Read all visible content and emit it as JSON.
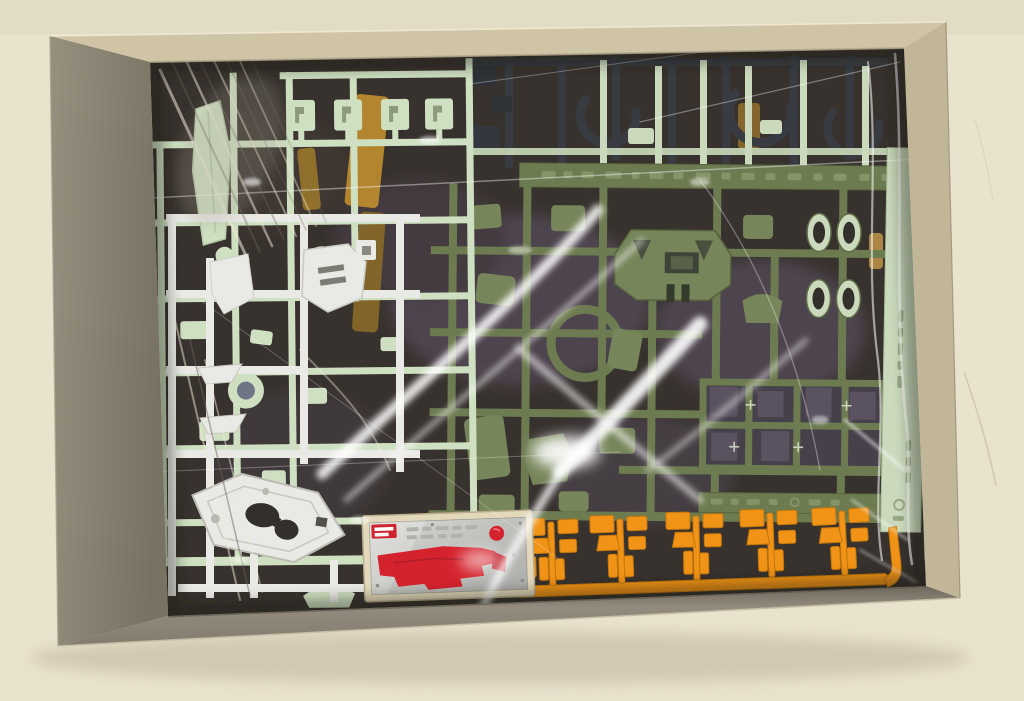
{
  "scene": {
    "type": "photograph",
    "description": "Top-down photo of an opened model-kit box on a cream tabletop; inside are clear plastic bags holding sprue runners of parts: pale mint-green, white, olive-green, dark gray and orange sprues, plus a cream-bordered metallic sticker sheet with large red decals",
    "setting": "cream tabletop / wall background",
    "legible_text": "none — embossed sprue markings and sticker print are too small to read"
  },
  "palette": {
    "background_wall": "#e9e2cd",
    "background_shadow": "#b6ab90",
    "box_wall_left": "#8e8878",
    "box_wall_front": "#8b8275",
    "box_wall_top": "#cfc4a6",
    "box_wall_right": "#c2b698",
    "box_interior": "#38322e",
    "interior_purple": "#5a5060",
    "sprue_mint": "#cfe0c2",
    "sprue_mint_dark": "#a9bf99",
    "sprue_white": "#e9e9e5",
    "sprue_white_shadow": "#c6c6bf",
    "sprue_olive": "#6d7b50",
    "sprue_olive_light": "#8b9a6d",
    "sprue_olive_part": "#76855a",
    "sprue_olive_deep": "#4f5a39",
    "sprue_navy": "#383c42",
    "sprue_pale_strip": "#cbdabd",
    "sprue_orange": "#f09317",
    "sprue_orange_dark": "#c4770c",
    "sticker_cream": "#e3d8ba",
    "sticker_silver": "#c6c6c2",
    "sticker_red": "#d5232e",
    "amber_part": "#b98a2e",
    "bag_highlight": "#ffffff"
  },
  "elements": [
    {
      "name": "cardboard-box",
      "desc": "open gray-brown box tray viewed from above"
    },
    {
      "name": "plastic-bag",
      "desc": "clear polybag with bright white wrinkle highlights"
    },
    {
      "name": "mint-sprue",
      "desc": "pale mint-green runner, upper/left, blade part and four small bracket parts"
    },
    {
      "name": "white-sprue",
      "desc": "white runner, left, chest parts and an elongated shield part"
    },
    {
      "name": "olive-sprue",
      "desc": "olive-green runner, center/right, torso, ring and leg parts, embossed label bars"
    },
    {
      "name": "navy-sprue",
      "desc": "dark gray runner, top right, three C-shaped parts"
    },
    {
      "name": "pale-strip",
      "desc": "pale green runner edge with embossed vertical text, right side"
    },
    {
      "name": "orange-sprue",
      "desc": "orange runner along the bottom with five small part clusters",
      "cluster_count": 5
    },
    {
      "name": "sticker-sheet",
      "desc": "cream-bordered metallic-silver sticker sheet",
      "red_shapes": [
        "large irregular decal",
        "round decal",
        "shield decal",
        "logo block"
      ]
    },
    {
      "name": "amber-parts",
      "desc": "translucent amber parts visible through the bag, upper left-center"
    }
  ]
}
